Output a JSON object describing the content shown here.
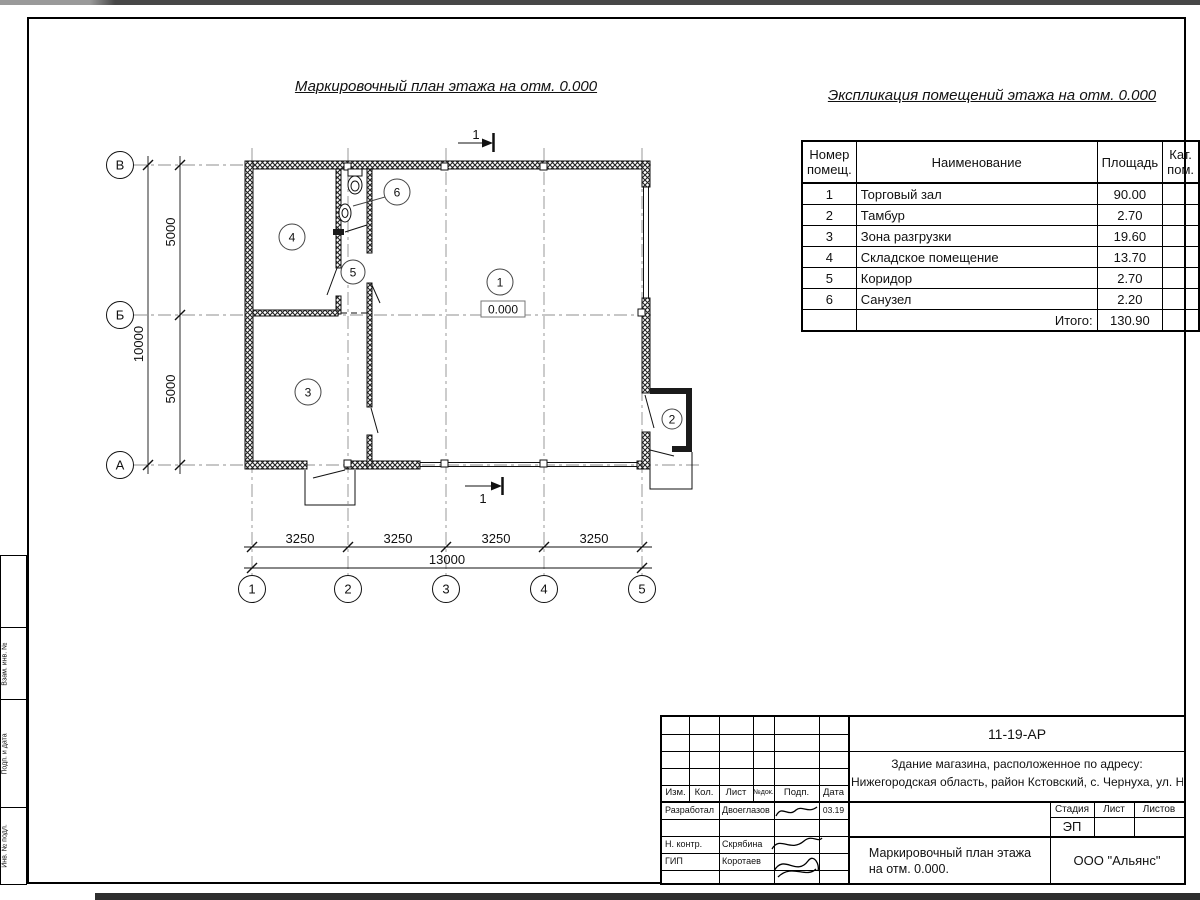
{
  "drawing": {
    "plan_title": "Маркировочный план этажа на отм. 0.000",
    "table_title": "Экспликация помещений этажа на отм. 0.000"
  },
  "plan": {
    "section_label": "1",
    "level_mark": "0.000",
    "room_numbers": [
      "1",
      "2",
      "3",
      "4",
      "5",
      "6"
    ],
    "axis_rows": [
      "В",
      "Б",
      "А"
    ],
    "axis_cols": [
      "1",
      "2",
      "3",
      "4",
      "5"
    ],
    "v_dims": [
      "5000",
      "5000"
    ],
    "v_total": "10000",
    "h_dims": [
      "3250",
      "3250",
      "3250",
      "3250"
    ],
    "h_total": "13000"
  },
  "schedule": {
    "header": {
      "num1": "Номер",
      "num2": "помещ.",
      "name": "Наименование",
      "area": "Площадь",
      "cat1": "Кат.",
      "cat2": "пом."
    },
    "rows": [
      {
        "num": "1",
        "name": "Торговый зал",
        "area": "90.00",
        "cat": ""
      },
      {
        "num": "2",
        "name": "Тамбур",
        "area": "2.70",
        "cat": ""
      },
      {
        "num": "3",
        "name": "Зона разгрузки",
        "area": "19.60",
        "cat": ""
      },
      {
        "num": "4",
        "name": "Складское помещение",
        "area": "13.70",
        "cat": ""
      },
      {
        "num": "5",
        "name": "Коридор",
        "area": "2.70",
        "cat": ""
      },
      {
        "num": "6",
        "name": "Санузел",
        "area": "2.20",
        "cat": ""
      }
    ],
    "total_label": "Итого:",
    "total_value": "130.90",
    "total_cat": ""
  },
  "titleblock": {
    "doc_number": "11-19-АР",
    "object_line1": "Здание магазина, расположенное по адресу:",
    "object_line2": "Нижегородская область, район Кстовский, с. Чернуха, ул. Нов",
    "cols": {
      "izm": "Изм.",
      "kol": "Кол.",
      "list": "Лист",
      "ndok": "№док.",
      "podp": "Подп.",
      "data": "Дата"
    },
    "stage": {
      "h1": "Стадия",
      "h2": "Лист",
      "h3": "Листов",
      "value": "ЭП"
    },
    "sheet_title1": "Маркировочный план этажа",
    "sheet_title2": "на отм. 0.000.",
    "company": "ООО \"Альянс\"",
    "rows": [
      {
        "role": "Разработал",
        "name": "Двоеглазов",
        "date": "03.19"
      },
      {
        "role": "Н. контр.",
        "name": "Скрябина",
        "date": ""
      },
      {
        "role": "ГИП",
        "name": "Коротаев",
        "date": ""
      }
    ]
  },
  "frame": {
    "side_labels": [
      "Взам. инв. №",
      "Подп. и дата",
      "Инв. № подл."
    ]
  }
}
